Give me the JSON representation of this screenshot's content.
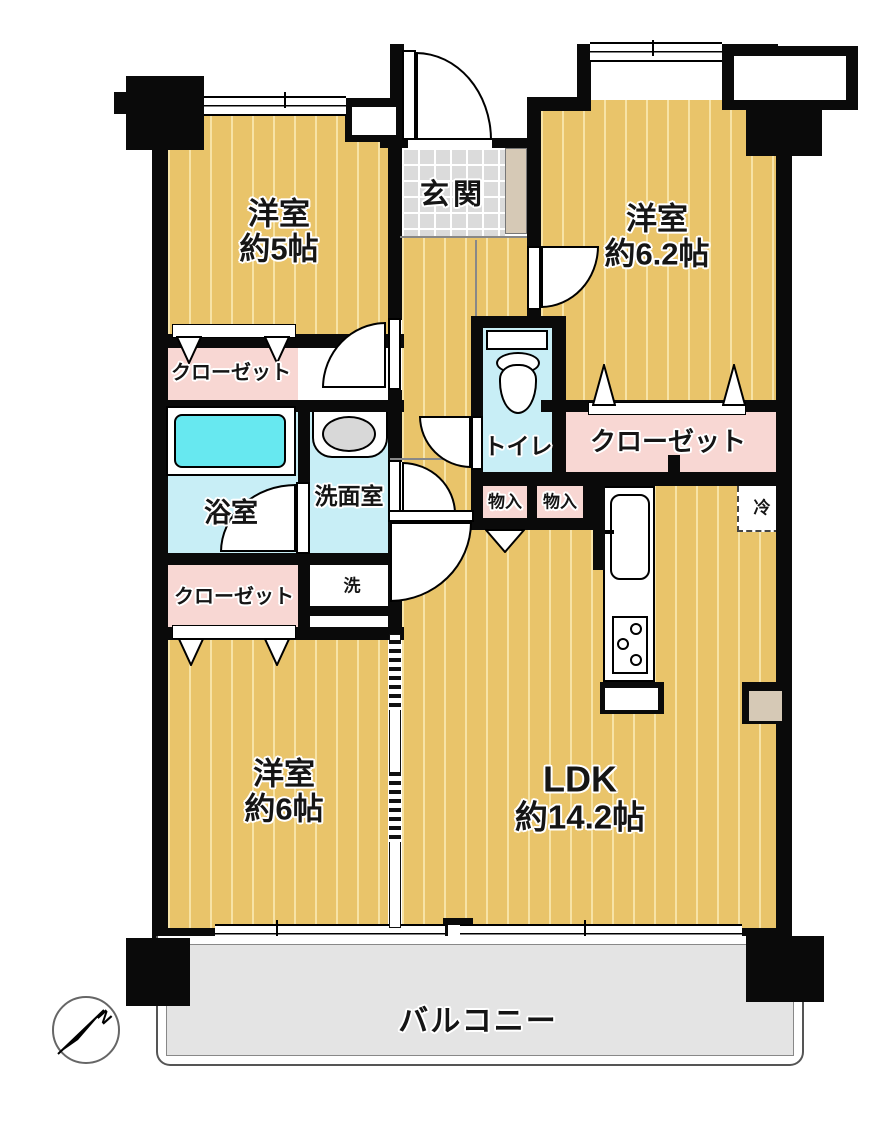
{
  "plan": {
    "rooms": {
      "bedroom_nw": {
        "label": "洋室",
        "area": "約5帖"
      },
      "bedroom_ne": {
        "label": "洋室",
        "area": "約6.2帖"
      },
      "bedroom_sw": {
        "label": "洋室",
        "area": "約6帖"
      },
      "ldk": {
        "label": "LDK",
        "area": "約14.2帖"
      },
      "entrance": {
        "label": "玄関"
      },
      "bathroom": {
        "label": "浴室"
      },
      "washroom": {
        "label": "洗面室"
      },
      "toilet": {
        "label": "トイレ"
      },
      "laundry": {
        "label": "洗"
      },
      "refrigerator": {
        "label": "冷"
      },
      "closet_nw": {
        "label": "クローゼット"
      },
      "closet_sw": {
        "label": "クローゼット"
      },
      "closet_e": {
        "label": "クローゼット"
      },
      "storage_1": {
        "label": "物入"
      },
      "storage_2": {
        "label": "物入"
      },
      "balcony": {
        "label": "バルコニー"
      }
    },
    "compass": {
      "north": "N"
    }
  },
  "colors": {
    "wall": "#0a0a0a",
    "floor": "#e9c46a",
    "floor-stripe": "#f7e3a6",
    "closet-pink": "#f8d7d3",
    "wet-cyan": "#c8eef6",
    "tub-cyan": "#67e8f0",
    "tile-gray": "#dbdbdb",
    "balcony-gray": "#e4e4e4",
    "cabinet-beige": "#d6c9b6"
  }
}
